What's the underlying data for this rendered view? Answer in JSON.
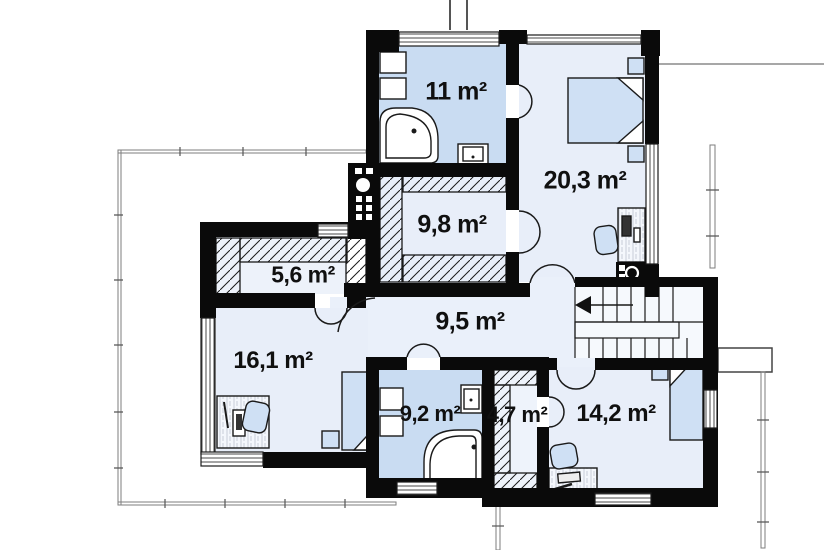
{
  "plan": {
    "rooms": [
      {
        "id": "bathroom-top",
        "label": "11 m²"
      },
      {
        "id": "bedroom-right",
        "label": "20,3 m²"
      },
      {
        "id": "wardrobe",
        "label": "9,8 m²"
      },
      {
        "id": "closet-left",
        "label": "5,6 m²"
      },
      {
        "id": "hallway",
        "label": "9,5 m²"
      },
      {
        "id": "bedroom-left",
        "label": "16,1 m²"
      },
      {
        "id": "bathroom-bottom",
        "label": "9,2 m²"
      },
      {
        "id": "closet-small",
        "label": "4,7 m²"
      },
      {
        "id": "bedroom-bottom",
        "label": "14,2 m²"
      }
    ],
    "colors": {
      "wall": "#0a0a0a",
      "room_floor": "#e8eef9",
      "bath_floor": "#c9dcf2",
      "furniture": "#cfe0f4",
      "background": "#ffffff"
    }
  }
}
